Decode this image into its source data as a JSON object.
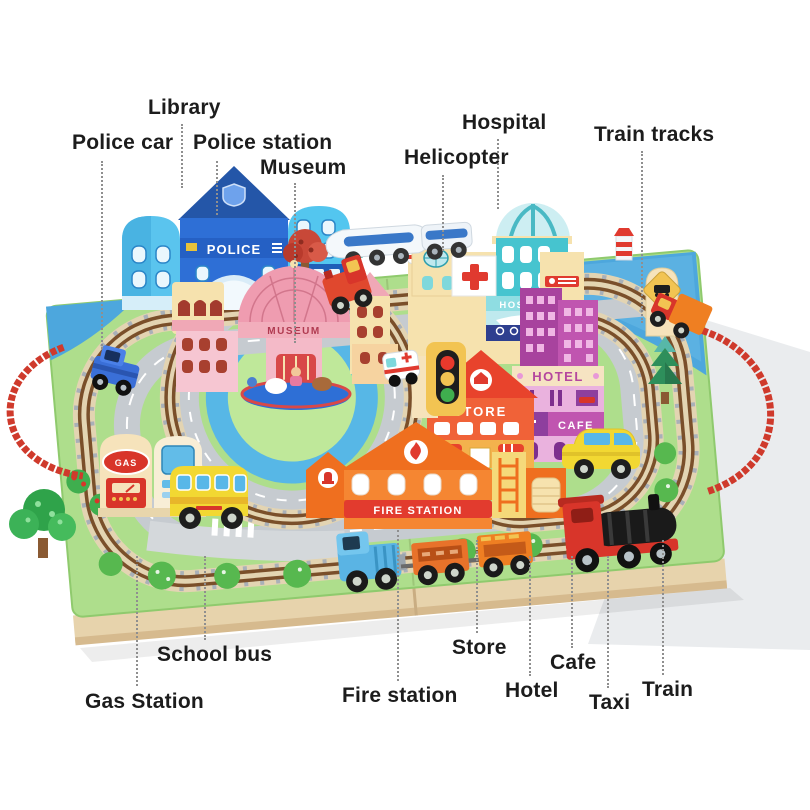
{
  "image_type": "annotated product photo of a wooden toy train table",
  "labels": {
    "library": "Library",
    "police_car": "Police car",
    "police_station": "Police station",
    "museum": "Museum",
    "helicopter": "Helicopter",
    "hospital": "Hospital",
    "train_tracks": "Train tracks",
    "school_bus": "School bus",
    "gas_station": "Gas Station",
    "fire_station": "Fire station",
    "store": "Store",
    "hotel": "Hotel",
    "cafe": "Cafe",
    "taxi": "Taxi",
    "train": "Train"
  },
  "signs": {
    "police": "POLICE",
    "museum": "MUSEUM",
    "hospital": "HOSPITAL",
    "store": "STORE",
    "hotel": "HOTEL",
    "cafe": "CAFE",
    "fire_station": "FIRE STATION",
    "gas": "GAS"
  },
  "colors": {
    "label_text": "#1c1c1c",
    "leader_dots": "#8f8f8f",
    "board_wood": "#e7d3ac",
    "mat_green": "#aede8c",
    "road_gray": "#c6cbd0",
    "track_rail_brown": "#7a4f2a",
    "water_blue": "#4da7dd",
    "rope_red": "#cf3a2c",
    "police_blue": "#2e6fd6",
    "hospital_teal": "#46c4cf",
    "store_red": "#f06238",
    "hotel_purple": "#b5479e",
    "fire_orange": "#f58632",
    "bus_taxi_yellow": "#f2d832",
    "train_red": "#d8352a"
  }
}
